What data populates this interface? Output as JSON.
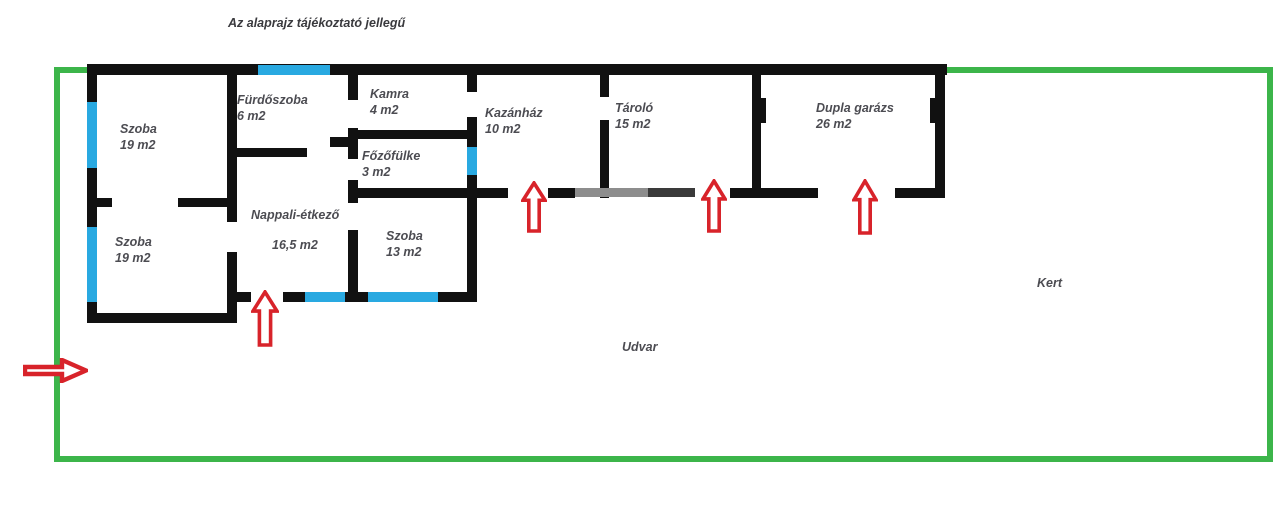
{
  "title": {
    "text": "Az alaprajz tájékoztató jellegű",
    "x": 228,
    "y": 16
  },
  "colors": {
    "wall": "#111111",
    "faded_wall": "#8d8d8d",
    "faded_wall_dark": "#3a3a3a",
    "window": "#29a9e1",
    "arrow": "#d8232a",
    "boundary": "#3cb54a",
    "label": "#4c4c52"
  },
  "boundary": {
    "x": 54,
    "y": 67,
    "width": 1219,
    "height": 395,
    "thickness": 6
  },
  "rooms": [
    {
      "id": "szoba-top-left",
      "name": "Szoba",
      "area": "19 m2",
      "x": 120,
      "y": 121,
      "spread": false
    },
    {
      "id": "szoba-bottom-left",
      "name": "Szoba",
      "area": "19 m2",
      "x": 115,
      "y": 234,
      "spread": false
    },
    {
      "id": "furdoszoba",
      "name": "Fürdőszoba",
      "area": "6 m2",
      "x": 237,
      "y": 92,
      "spread": false
    },
    {
      "id": "kamra",
      "name": "Kamra",
      "area": "4 m2",
      "x": 370,
      "y": 86,
      "spread": false
    },
    {
      "id": "fozofulke",
      "name": "Főzőfülke",
      "area": "3 m2",
      "x": 362,
      "y": 148,
      "spread": false
    },
    {
      "id": "nappali-etkezo",
      "name": "Nappali-étkező",
      "area": "16,5 m2",
      "x": 251,
      "y": 207,
      "spread": true
    },
    {
      "id": "szoba-13",
      "name": "Szoba",
      "area": "13 m2",
      "x": 386,
      "y": 228,
      "spread": false
    },
    {
      "id": "kazanhaz",
      "name": "Kazánház",
      "area": "10 m2",
      "x": 485,
      "y": 105,
      "spread": false
    },
    {
      "id": "tarolo",
      "name": "Tároló",
      "area": "15 m2",
      "x": 615,
      "y": 100,
      "spread": false
    },
    {
      "id": "dupla-garazs",
      "name": "Dupla garázs",
      "area": "26 m2",
      "x": 816,
      "y": 100,
      "spread": false
    }
  ],
  "outdoor_labels": [
    {
      "id": "udvar",
      "text": "Udvar",
      "x": 622,
      "y": 340
    },
    {
      "id": "kert",
      "text": "Kert",
      "x": 1037,
      "y": 276
    }
  ],
  "walls": [
    {
      "id": "top-wall",
      "x": 87,
      "y": 64,
      "w": 860,
      "h": 11
    },
    {
      "id": "left-wall",
      "x": 87,
      "y": 64,
      "w": 10,
      "h": 259
    },
    {
      "id": "szoba-bl-bottom-wall",
      "x": 87,
      "y": 313,
      "w": 150,
      "h": 10
    },
    {
      "id": "szoba-divider-wall-a",
      "x": 87,
      "y": 198,
      "w": 25,
      "h": 9
    },
    {
      "id": "szoba-divider-wall-b",
      "x": 178,
      "y": 198,
      "w": 59,
      "h": 9
    },
    {
      "id": "szoba-nappali-wall-upper",
      "x": 227,
      "y": 64,
      "w": 10,
      "h": 158
    },
    {
      "id": "szoba-nappali-wall-lower",
      "x": 227,
      "y": 252,
      "w": 10,
      "h": 71
    },
    {
      "id": "nappali-bottom-stub",
      "x": 227,
      "y": 292,
      "w": 24,
      "h": 10
    },
    {
      "id": "nappali-szoba13-bottom-wall",
      "x": 283,
      "y": 292,
      "w": 194,
      "h": 10
    },
    {
      "id": "furdoszoba-bottom-wall",
      "x": 233,
      "y": 148,
      "w": 74,
      "h": 9
    },
    {
      "id": "furdoszoba-door-stub",
      "x": 330,
      "y": 137,
      "w": 28,
      "h": 10
    },
    {
      "id": "kamra-left-wall-a",
      "x": 348,
      "y": 64,
      "w": 10,
      "h": 36
    },
    {
      "id": "kamra-left-wall-b",
      "x": 348,
      "y": 128,
      "w": 10,
      "h": 31
    },
    {
      "id": "fozofulke-door-post",
      "x": 348,
      "y": 180,
      "w": 10,
      "h": 23
    },
    {
      "id": "szoba13-left-wall",
      "x": 348,
      "y": 230,
      "w": 10,
      "h": 72
    },
    {
      "id": "kamra-bottom-wall",
      "x": 352,
      "y": 130,
      "w": 125,
      "h": 9
    },
    {
      "id": "fozofulke-bottom-wall",
      "x": 348,
      "y": 188,
      "w": 129,
      "h": 10
    },
    {
      "id": "kazanhaz-left-wall-a",
      "x": 467,
      "y": 64,
      "w": 10,
      "h": 28
    },
    {
      "id": "kazanhaz-left-wall-b",
      "x": 467,
      "y": 117,
      "w": 10,
      "h": 30
    },
    {
      "id": "kazanhaz-left-wall-c",
      "x": 467,
      "y": 175,
      "w": 10,
      "h": 127
    },
    {
      "id": "kazanhaz-tarolo-wall-a",
      "x": 600,
      "y": 64,
      "w": 9,
      "h": 33
    },
    {
      "id": "kazanhaz-tarolo-wall-b",
      "x": 600,
      "y": 120,
      "w": 9,
      "h": 78
    },
    {
      "id": "tarolo-garazs-wall",
      "x": 752,
      "y": 64,
      "w": 9,
      "h": 134
    },
    {
      "id": "garazs-door-jamb",
      "x": 761,
      "y": 98,
      "w": 5,
      "h": 25
    },
    {
      "id": "right-wall",
      "x": 935,
      "y": 64,
      "w": 10,
      "h": 134
    },
    {
      "id": "right-wall-door-jamb",
      "x": 930,
      "y": 98,
      "w": 5,
      "h": 25
    },
    {
      "id": "south-wall-kazanhaz-left",
      "x": 477,
      "y": 188,
      "w": 31,
      "h": 10
    },
    {
      "id": "south-wall-kazanhaz-right",
      "x": 548,
      "y": 188,
      "w": 27,
      "h": 10
    },
    {
      "id": "south-wall-faded",
      "x": 575,
      "y": 188,
      "w": 120,
      "h": 9,
      "color": "#8d8d8d"
    },
    {
      "id": "south-wall-faded-dark",
      "x": 648,
      "y": 188,
      "w": 47,
      "h": 9,
      "color": "#3a3a3a"
    },
    {
      "id": "south-wall-tarolo-garazs",
      "x": 730,
      "y": 188,
      "w": 88,
      "h": 10
    },
    {
      "id": "south-wall-garazs-right",
      "x": 895,
      "y": 188,
      "w": 50,
      "h": 10
    }
  ],
  "windows": [
    {
      "id": "furdoszoba-top-window",
      "x": 258,
      "y": 65,
      "w": 72,
      "h": 10
    },
    {
      "id": "szoba-tl-window",
      "x": 87,
      "y": 102,
      "w": 10,
      "h": 66
    },
    {
      "id": "szoba-bl-window",
      "x": 87,
      "y": 227,
      "w": 10,
      "h": 75
    },
    {
      "id": "kazanhaz-window",
      "x": 467,
      "y": 147,
      "w": 10,
      "h": 28
    },
    {
      "id": "nappali-window",
      "x": 305,
      "y": 292,
      "w": 40,
      "h": 10
    },
    {
      "id": "szoba13-window",
      "x": 368,
      "y": 292,
      "w": 70,
      "h": 10
    }
  ],
  "door_arrows": [
    {
      "id": "entrance-arrow-gate",
      "dir": "right",
      "x": 23,
      "y": 358,
      "w": 65,
      "h": 25
    },
    {
      "id": "entrance-arrow-nappali",
      "dir": "up",
      "x": 251,
      "y": 290,
      "w": 28,
      "h": 57
    },
    {
      "id": "entrance-arrow-kazanhaz",
      "dir": "up",
      "x": 521,
      "y": 181,
      "w": 26,
      "h": 52
    },
    {
      "id": "entrance-arrow-tarolo",
      "dir": "up",
      "x": 701,
      "y": 179,
      "w": 26,
      "h": 54
    },
    {
      "id": "entrance-arrow-garazs",
      "dir": "up",
      "x": 852,
      "y": 179,
      "w": 26,
      "h": 56
    }
  ]
}
